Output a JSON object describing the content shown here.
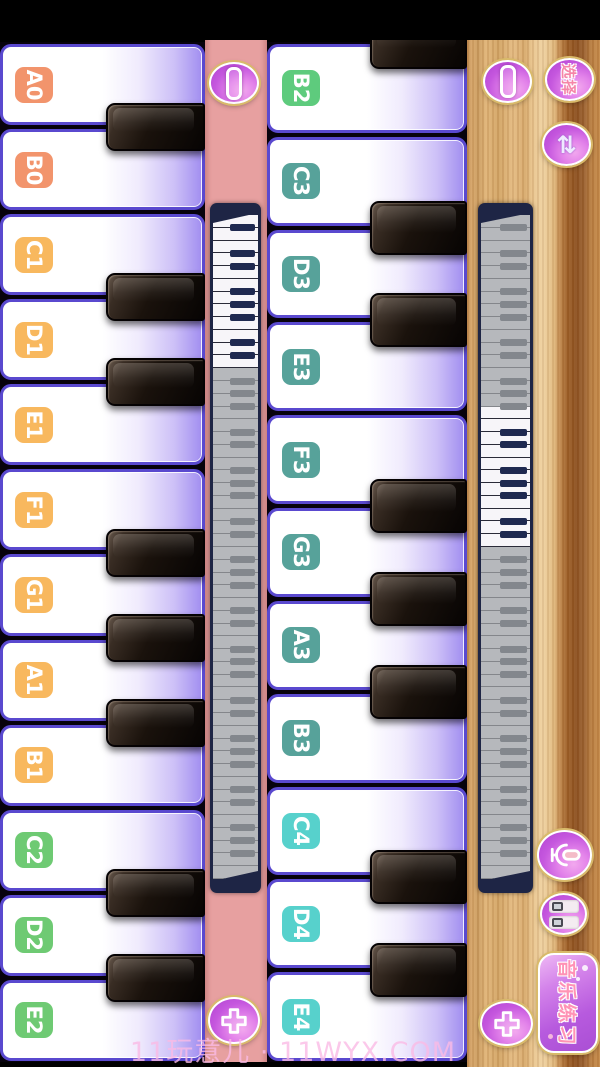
{
  "watermark": "11玩意儿 · 11WYX.COM",
  "left_piano": {
    "keys": [
      {
        "label": "A0",
        "color": "#f2946c"
      },
      {
        "label": "B0",
        "color": "#f2946c"
      },
      {
        "label": "C1",
        "color": "#f8b85e"
      },
      {
        "label": "D1",
        "color": "#f8b85e"
      },
      {
        "label": "E1",
        "color": "#f8b85e"
      },
      {
        "label": "F1",
        "color": "#f8b85e"
      },
      {
        "label": "G1",
        "color": "#f8b85e"
      },
      {
        "label": "A1",
        "color": "#f8b85e"
      },
      {
        "label": "B1",
        "color": "#f8b85e"
      },
      {
        "label": "C2",
        "color": "#6eca73"
      },
      {
        "label": "D2",
        "color": "#6eca73"
      },
      {
        "label": "E2",
        "color": "#6eca73"
      }
    ],
    "black_after": [
      0,
      2,
      3,
      5,
      6,
      7,
      9,
      10
    ],
    "partial_black_top": false
  },
  "right_piano": {
    "keys": [
      {
        "label": "B2",
        "color": "#5ecb7d"
      },
      {
        "label": "C3",
        "color": "#57a29a"
      },
      {
        "label": "D3",
        "color": "#57a29a"
      },
      {
        "label": "E3",
        "color": "#57a29a"
      },
      {
        "label": "F3",
        "color": "#57a29a"
      },
      {
        "label": "G3",
        "color": "#57a29a"
      },
      {
        "label": "A3",
        "color": "#57a29a"
      },
      {
        "label": "B3",
        "color": "#57a29a"
      },
      {
        "label": "C4",
        "color": "#57d1cc"
      },
      {
        "label": "D4",
        "color": "#57d1cc"
      },
      {
        "label": "E4",
        "color": "#57d1cc"
      }
    ],
    "black_after": [
      1,
      2,
      4,
      5,
      6,
      8,
      9
    ],
    "partial_black_top": true
  },
  "left_strip": {
    "pause_icon": "vertical-bar",
    "add_icon": "plus",
    "minimap": {
      "white_key_count": 52,
      "active_start": 0,
      "active_count": 12
    }
  },
  "right_strip": {
    "pause_icon": "vertical-bar",
    "select_label": "选择",
    "swap_icon": "⇅",
    "mic_icon": "microphone",
    "toggles_icon": "double-switch",
    "practice_label": "音乐练习",
    "add_icon": "plus",
    "minimap": {
      "white_key_count": 52,
      "active_start": 15,
      "active_count": 11
    }
  },
  "colors": {
    "strip_pink": "#e7a0a0",
    "wood_light": "#e9c48d",
    "wood_dark": "#8c5020",
    "key_border_purple": "#5a49cf",
    "button_magenta": "#c557de",
    "ring_gold": "#d9ba6a",
    "octave0_label": "#f2946c",
    "octave1_label": "#f8b85e",
    "octave2_label": "#6eca73",
    "octave3_label": "#57a29a",
    "octave4_label": "#57d1cc"
  }
}
